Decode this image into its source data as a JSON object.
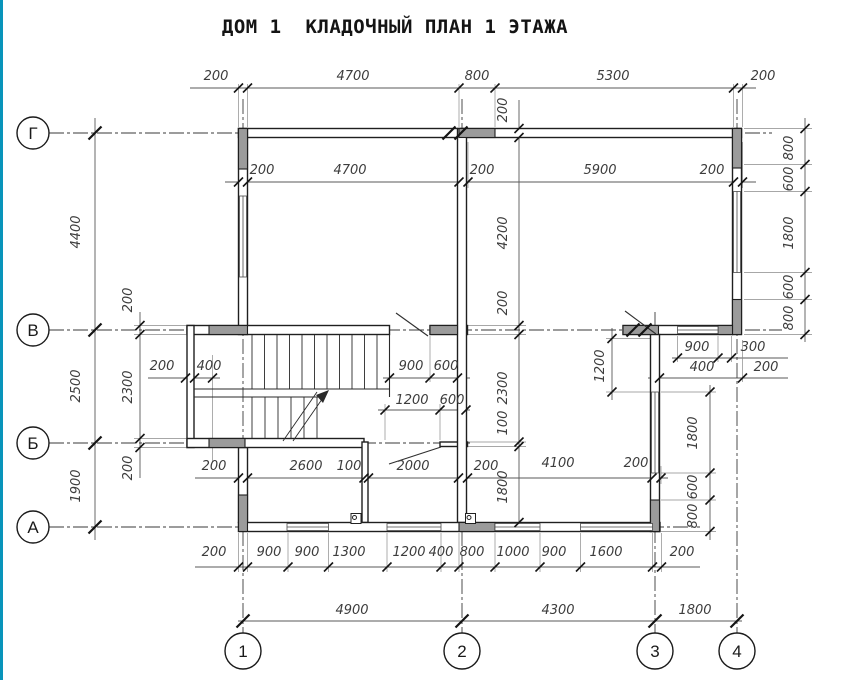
{
  "title": "ДОМ 1  КЛАДОЧНЫЙ ПЛАН 1 ЭТАЖА",
  "colors": {
    "accent_bar": "#0894ba",
    "wall_line": "#1f1f1f",
    "pier_fill": "#9b9b9b",
    "dim_line": "#5a5a5a",
    "dim_text": "#3d3d3d",
    "background": "#ffffff"
  },
  "axes": {
    "horizontal_bubbles": [
      {
        "label": "Г",
        "cx": 33,
        "cy": 133
      },
      {
        "label": "В",
        "cx": 33,
        "cy": 330
      },
      {
        "label": "Б",
        "cx": 33,
        "cy": 443
      },
      {
        "label": "А",
        "cx": 33,
        "cy": 527
      }
    ],
    "vertical_bubbles": [
      {
        "label": "1",
        "cx": 243,
        "cy": 651
      },
      {
        "label": "2",
        "cx": 462,
        "cy": 651
      },
      {
        "label": "3",
        "cx": 655,
        "cy": 651
      },
      {
        "label": "4",
        "cx": 737,
        "cy": 651
      }
    ]
  },
  "dimension_chains": {
    "top_outer": [
      "200",
      "4700",
      "800",
      "5300",
      "200"
    ],
    "top_inner": [
      "200",
      "4700",
      "200",
      "5900",
      "200"
    ],
    "left_outer": [
      "4400",
      "2500",
      "1900"
    ],
    "left_inner": [
      "200",
      "2300",
      "200"
    ],
    "right_outer": [
      "800",
      "600",
      "1800",
      "600",
      "800"
    ],
    "center_vertical": [
      "200",
      "4200",
      "200",
      "2300",
      "100",
      "1800"
    ],
    "axis3_pier": [
      "1200"
    ],
    "axis3_vertical": [
      "1800",
      "600",
      "800"
    ],
    "stair_dims": [
      "200",
      "400"
    ],
    "door_v_left": [
      "900",
      "600"
    ],
    "door_b": [
      "1200",
      "600"
    ],
    "wall_v_right": [
      "400",
      "900",
      "300",
      "200"
    ],
    "inner_bottom_row": [
      "200",
      "2600",
      "100",
      "2000",
      "200",
      "4100",
      "200"
    ],
    "bottom_openings": [
      "200",
      "900",
      "900",
      "1300",
      "1200",
      "400",
      "800",
      "1000",
      "900",
      "1600",
      "200"
    ],
    "bottom_axes": [
      "4900",
      "4300",
      "1800"
    ]
  },
  "plan": {
    "labels": [
      {
        "t": "200",
        "x": 216,
        "y": 80,
        "r": 0
      },
      {
        "t": "4700",
        "x": 353,
        "y": 80,
        "r": 0
      },
      {
        "t": "800",
        "x": 477,
        "y": 80,
        "r": 0
      },
      {
        "t": "5300",
        "x": 613,
        "y": 80,
        "r": 0
      },
      {
        "t": "200",
        "x": 763,
        "y": 80,
        "r": 0
      },
      {
        "t": "200",
        "x": 262,
        "y": 174,
        "r": 0
      },
      {
        "t": "4700",
        "x": 350,
        "y": 174,
        "r": 0
      },
      {
        "t": "200",
        "x": 482,
        "y": 174,
        "r": 0
      },
      {
        "t": "5900",
        "x": 600,
        "y": 174,
        "r": 0
      },
      {
        "t": "200",
        "x": 712,
        "y": 174,
        "r": 0
      },
      {
        "t": "800",
        "x": 793,
        "y": 148,
        "r": 1
      },
      {
        "t": "600",
        "x": 793,
        "y": 179,
        "r": 1
      },
      {
        "t": "1800",
        "x": 793,
        "y": 233,
        "r": 1
      },
      {
        "t": "600",
        "x": 793,
        "y": 287,
        "r": 1
      },
      {
        "t": "800",
        "x": 793,
        "y": 318,
        "r": 1
      },
      {
        "t": "4400",
        "x": 80,
        "y": 232,
        "r": 1
      },
      {
        "t": "2500",
        "x": 80,
        "y": 386,
        "r": 1
      },
      {
        "t": "1900",
        "x": 80,
        "y": 486,
        "r": 1
      },
      {
        "t": "200",
        "x": 132,
        "y": 300,
        "r": 1
      },
      {
        "t": "2300",
        "x": 132,
        "y": 387,
        "r": 1
      },
      {
        "t": "200",
        "x": 132,
        "y": 468,
        "r": 1
      },
      {
        "t": "200",
        "x": 507,
        "y": 110,
        "r": 1
      },
      {
        "t": "4200",
        "x": 507,
        "y": 233,
        "r": 1
      },
      {
        "t": "200",
        "x": 507,
        "y": 303,
        "r": 1
      },
      {
        "t": "2300",
        "x": 507,
        "y": 388,
        "r": 1
      },
      {
        "t": "100",
        "x": 507,
        "y": 423,
        "r": 1
      },
      {
        "t": "1800",
        "x": 507,
        "y": 487,
        "r": 1
      },
      {
        "t": "200",
        "x": 162,
        "y": 370,
        "r": 0
      },
      {
        "t": "400",
        "x": 209,
        "y": 370,
        "r": 0
      },
      {
        "t": "900",
        "x": 411,
        "y": 370,
        "r": 0
      },
      {
        "t": "600",
        "x": 446,
        "y": 370,
        "r": 0
      },
      {
        "t": "1200",
        "x": 412,
        "y": 404,
        "r": 0
      },
      {
        "t": "600",
        "x": 452,
        "y": 404,
        "r": 0
      },
      {
        "t": "900",
        "x": 697,
        "y": 351,
        "r": 0
      },
      {
        "t": "300",
        "x": 753,
        "y": 351,
        "r": 0
      },
      {
        "t": "400",
        "x": 702,
        "y": 371,
        "r": 0
      },
      {
        "t": "200",
        "x": 766,
        "y": 371,
        "r": 0
      },
      {
        "t": "1200",
        "x": 604,
        "y": 366,
        "r": 1
      },
      {
        "t": "1800",
        "x": 697,
        "y": 433,
        "r": 1
      },
      {
        "t": "600",
        "x": 697,
        "y": 487,
        "r": 1
      },
      {
        "t": "800",
        "x": 697,
        "y": 516,
        "r": 1
      },
      {
        "t": "200",
        "x": 214,
        "y": 470,
        "r": 0
      },
      {
        "t": "2600",
        "x": 306,
        "y": 470,
        "r": 0
      },
      {
        "t": "100",
        "x": 349,
        "y": 470,
        "r": 0
      },
      {
        "t": "2000",
        "x": 413,
        "y": 470,
        "r": 0
      },
      {
        "t": "200",
        "x": 486,
        "y": 470,
        "r": 0
      },
      {
        "t": "4100",
        "x": 558,
        "y": 467,
        "r": 0
      },
      {
        "t": "200",
        "x": 636,
        "y": 467,
        "r": 0
      },
      {
        "t": "200",
        "x": 214,
        "y": 556,
        "r": 0
      },
      {
        "t": "900",
        "x": 269,
        "y": 556,
        "r": 0
      },
      {
        "t": "900",
        "x": 307,
        "y": 556,
        "r": 0
      },
      {
        "t": "1300",
        "x": 349,
        "y": 556,
        "r": 0
      },
      {
        "t": "1200",
        "x": 409,
        "y": 556,
        "r": 0
      },
      {
        "t": "400",
        "x": 441,
        "y": 556,
        "r": 0
      },
      {
        "t": "800",
        "x": 472,
        "y": 556,
        "r": 0
      },
      {
        "t": "1000",
        "x": 513,
        "y": 556,
        "r": 0
      },
      {
        "t": "900",
        "x": 554,
        "y": 556,
        "r": 0
      },
      {
        "t": "1600",
        "x": 606,
        "y": 556,
        "r": 0
      },
      {
        "t": "200",
        "x": 682,
        "y": 556,
        "r": 0
      },
      {
        "t": "4900",
        "x": 352,
        "y": 614,
        "r": 0
      },
      {
        "t": "4300",
        "x": 558,
        "y": 614,
        "r": 0
      },
      {
        "t": "1800",
        "x": 695,
        "y": 614,
        "r": 0
      }
    ]
  }
}
